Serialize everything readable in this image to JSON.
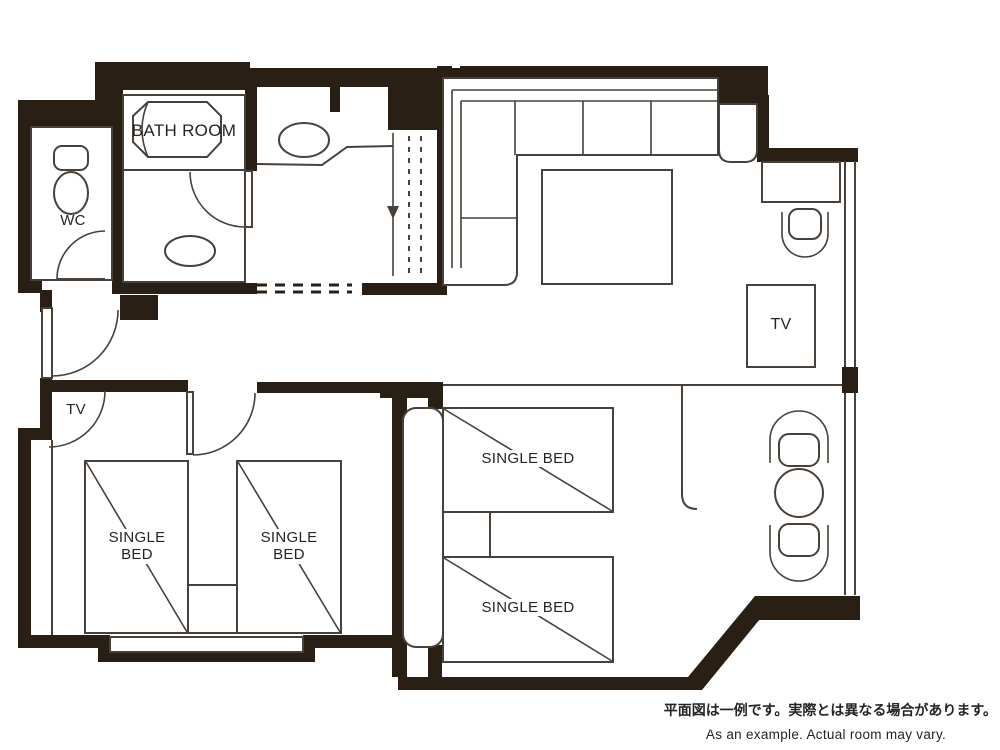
{
  "floorplan": {
    "colors": {
      "wall": "#2a1f15",
      "line": "#48403a",
      "text": "#242424"
    },
    "labels": {
      "bathroom": "BATH ROOM",
      "wc": "WC",
      "tv": "TV",
      "single_bed": "SINGLE BED"
    },
    "caption": {
      "ja": "平面図は一例です。実際とは異なる場合があります。",
      "en": "As an example. Actual room may vary."
    }
  }
}
